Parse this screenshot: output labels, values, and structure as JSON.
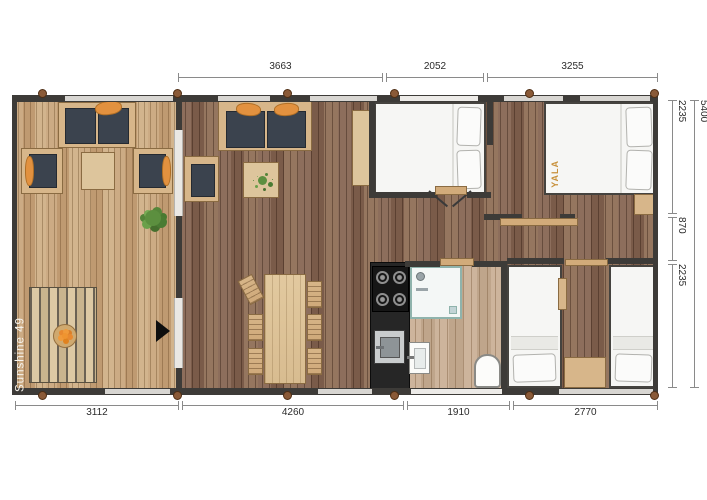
{
  "plan": {
    "model_label": "Sunshine 49",
    "brand_label": "YALA"
  },
  "dimensions": {
    "top": [
      {
        "label": "3663"
      },
      {
        "label": "2052"
      },
      {
        "label": "3255"
      }
    ],
    "bottom": [
      {
        "label": "3112"
      },
      {
        "label": "4260"
      },
      {
        "label": "1910"
      },
      {
        "label": "2770"
      }
    ],
    "right": [
      {
        "label": "2235"
      },
      {
        "label": "870"
      },
      {
        "label": "2235"
      }
    ],
    "right_total": {
      "label": "5400"
    }
  },
  "colors": {
    "wall": "#3d3b38",
    "deck_wood": "#c6a47c",
    "interior_wood": "#86685a",
    "bathroom_wood": "#c9b49f",
    "furniture_wood": "#d7b68a",
    "cushion_dark": "#3b434e",
    "accent_orange": "#e2913f",
    "bedding_white": "#f6f6f4",
    "kitchen_black": "#1c1c1c",
    "brand_gold": "#c8913c",
    "dimension_line": "#8a8a8a"
  }
}
